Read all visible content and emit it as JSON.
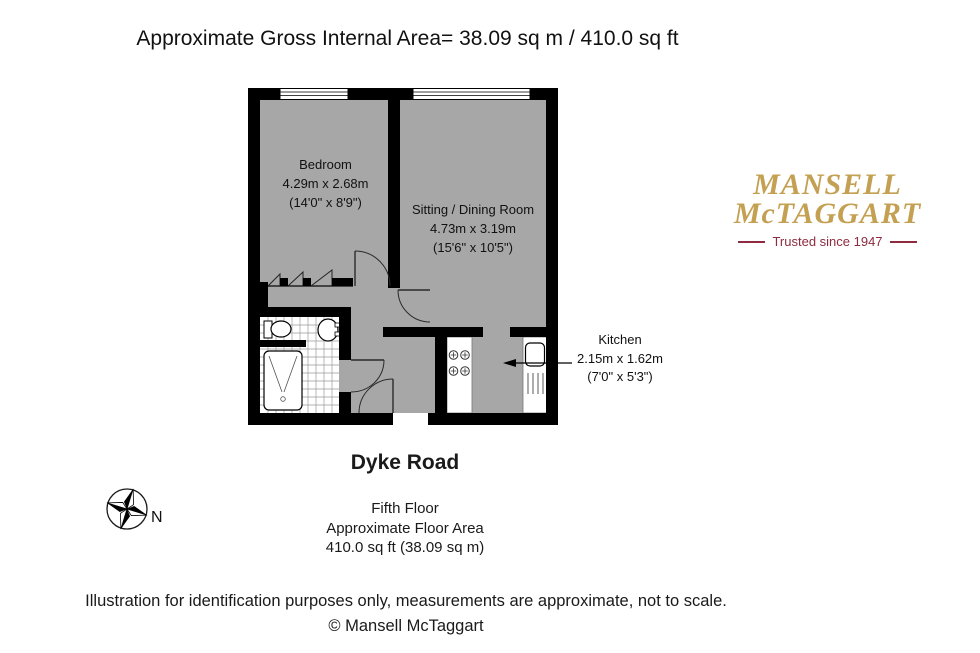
{
  "title": "Approximate Gross Internal Area= 38.09 sq m / 410.0 sq ft",
  "plan": {
    "bedroom": {
      "name": "Bedroom",
      "metric": "4.29m x 2.68m",
      "imperial": "(14'0\" x 8'9\")"
    },
    "sitting_dining": {
      "name": "Sitting / Dining Room",
      "metric": "4.73m x 3.19m",
      "imperial": "(15'6\" x 10'5\")"
    },
    "kitchen": {
      "name": "Kitchen",
      "metric": "2.15m x 1.62m",
      "imperial": "(7'0\" x 5'3\")"
    }
  },
  "logo": {
    "name_line1": "MANSELL",
    "name_line2": "McTAGGART",
    "tagline": "Trusted since 1947",
    "gold_color": "#C3A052",
    "maroon_color": "#8E2B3E"
  },
  "compass": {
    "north_label": "N"
  },
  "property": {
    "street": "Dyke Road",
    "floor": "Fifth Floor",
    "area_label": "Approximate Floor Area",
    "area_value": "410.0 sq ft (38.09 sq m)"
  },
  "footer": {
    "disclaimer": "Illustration for identification purposes only, measurements are approximate, not to scale.",
    "copyright": "© Mansell McTaggart"
  },
  "colors": {
    "wall": "#000000",
    "floor_fill": "#a7a7a7"
  }
}
